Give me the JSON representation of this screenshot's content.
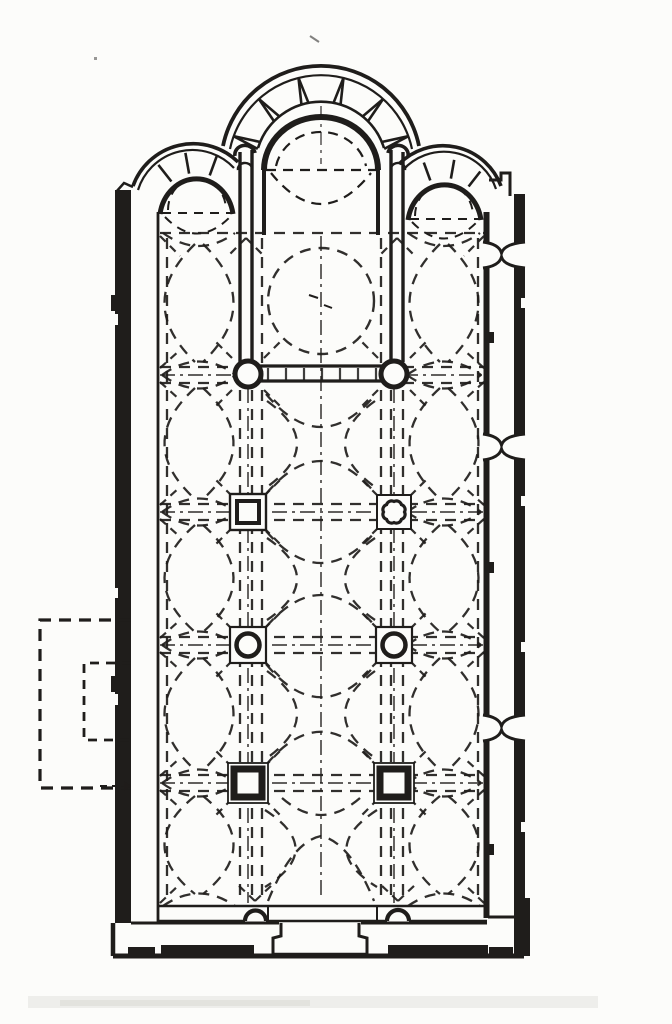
{
  "figure": {
    "type": "architectural floor plan",
    "subject": "Scanned black-ink floor plan of a three-apse cross-domed church: triple apse at top, chancel with templon barrier on two round columns, three further pairs of supports (double-square and octofoil piers, columns on square plinths, thick square piers), dashed vault and dome projections, double east wall with three hourglass wall-openings, dashed annex outside the west wall, portal at the south end",
    "background_color": "#fcfcfa",
    "ink_color": "#1f1d1b",
    "artifact_color": "#e9e9e5",
    "image_w": 672,
    "image_h": 1024
  },
  "plan": {
    "naos": {
      "left": 158,
      "right": 487,
      "top": 233,
      "bottom": 905
    },
    "nave_axis_x": 321,
    "arcade_x": [
      248,
      394
    ],
    "aisle_axes_x": [
      199,
      444
    ],
    "rows_y": [
      375,
      512,
      645,
      783
    ],
    "aisle_bay_bounds_y": [
      238,
      368,
      382,
      505,
      519,
      638,
      652,
      776,
      790,
      900
    ],
    "dashed_vertical_x": [
      167,
      240,
      252,
      262,
      381,
      391,
      403,
      478
    ],
    "dashdot_vertical_x": [
      248,
      394
    ],
    "gallery_openings_y": [
      255,
      447,
      728
    ],
    "supports": [
      {
        "type": "column",
        "name": "nw-column",
        "cx": 248,
        "cy": 374,
        "r": 13
      },
      {
        "type": "column",
        "name": "ne-column",
        "cx": 394,
        "cy": 374,
        "r": 13
      },
      {
        "type": "double-square-pier",
        "name": "w-pier-row2",
        "cx": 248,
        "cy": 512,
        "outer": 36,
        "inner": 22
      },
      {
        "type": "octofoil-pier",
        "name": "e-pier-row2",
        "cx": 394,
        "cy": 512,
        "outer": 34,
        "R": 10.5,
        "lobe_r": 5.2,
        "lobes": 8
      },
      {
        "type": "column-on-plinth",
        "name": "w-column-row3",
        "cx": 248,
        "cy": 645,
        "outer": 36,
        "r": 11.5
      },
      {
        "type": "column-on-plinth",
        "name": "e-column-row3",
        "cx": 394,
        "cy": 645,
        "outer": 36,
        "r": 11.5
      },
      {
        "type": "thick-square-pier",
        "name": "w-pier-row4",
        "cx": 248,
        "cy": 783,
        "outer": 40,
        "inner": 28
      },
      {
        "type": "thick-square-pier",
        "name": "e-pier-row4",
        "cx": 394,
        "cy": 783,
        "outer": 40,
        "inner": 28
      }
    ],
    "nave_bays": [
      {
        "kind": "dome",
        "cy": 301,
        "r": 53
      },
      {
        "kind": "groin",
        "y1": 389,
        "y2": 499
      },
      {
        "kind": "groin",
        "y1": 526,
        "y2": 632
      },
      {
        "kind": "groin",
        "y1": 659,
        "y2": 770
      },
      {
        "kind": "fan",
        "y1": 796,
        "y2": 903
      }
    ],
    "apse_joints": [
      {
        "cx": 321,
        "cy": 168,
        "r1": 66,
        "r2": 93,
        "spread": 3.2,
        "angles": [
          -70,
          -42,
          -14,
          14,
          42,
          70
        ]
      },
      {
        "cx": 196,
        "cy": 213,
        "r1": 40,
        "r2": 61,
        "spread": 0,
        "angles": [
          -38,
          -10,
          20
        ]
      },
      {
        "cx": 444,
        "cy": 218,
        "r1": 40,
        "r2": 59,
        "spread": 0,
        "angles": [
          -20,
          10,
          38
        ]
      }
    ],
    "templon": {
      "x1": 259,
      "x2": 385,
      "y1": 366,
      "y2": 381,
      "ticks": 7
    },
    "extra_springers": [
      [
        160,
        236,
        180,
        256
      ],
      [
        484,
        236,
        464,
        256
      ],
      [
        160,
        903,
        180,
        884
      ],
      [
        484,
        903,
        464,
        884
      ],
      [
        246,
        238,
        228,
        256
      ],
      [
        246,
        238,
        264,
        256
      ],
      [
        397,
        238,
        379,
        256
      ],
      [
        397,
        238,
        415,
        256
      ],
      [
        255,
        901,
        237,
        884
      ],
      [
        255,
        901,
        273,
        884
      ],
      [
        398,
        901,
        380,
        884
      ],
      [
        398,
        901,
        416,
        884
      ]
    ],
    "annex": {
      "outer": {
        "x1": 40,
        "y1": 620,
        "x2": 131,
        "y2": 788
      },
      "inner": {
        "x1": 84,
        "y1": 663,
        "x2": 131,
        "y2": 740
      }
    }
  }
}
